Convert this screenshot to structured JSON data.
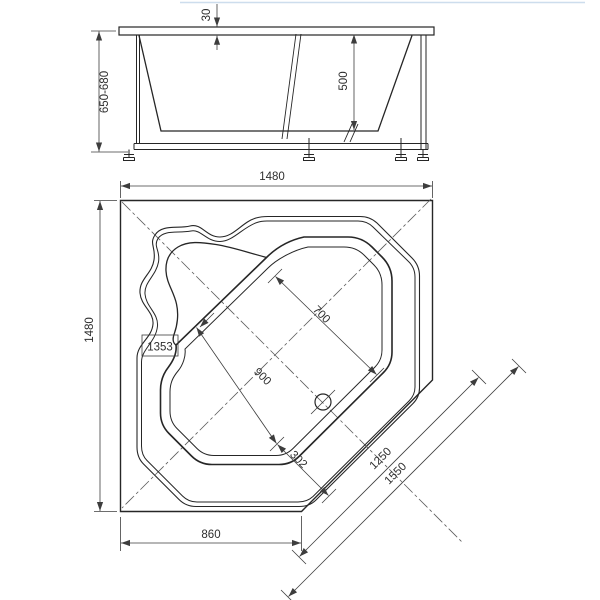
{
  "colors": {
    "line": "#262626",
    "dimension": "#3d3d3d",
    "background": "#ffffff",
    "top_edge_artifact": "#b9cfe6"
  },
  "front_view": {
    "rim_thickness": "30",
    "overall_height": "650-680",
    "basin_depth": "500"
  },
  "plan_view": {
    "overall_width": "1480",
    "overall_depth": "1480",
    "corner_diagonal": "1353",
    "basin_width": "700",
    "basin_diagonal_length": "900",
    "drain_offset": "302",
    "front_edge_width": "1250",
    "front_overall_width": "1550",
    "side_cut_width": "860"
  }
}
